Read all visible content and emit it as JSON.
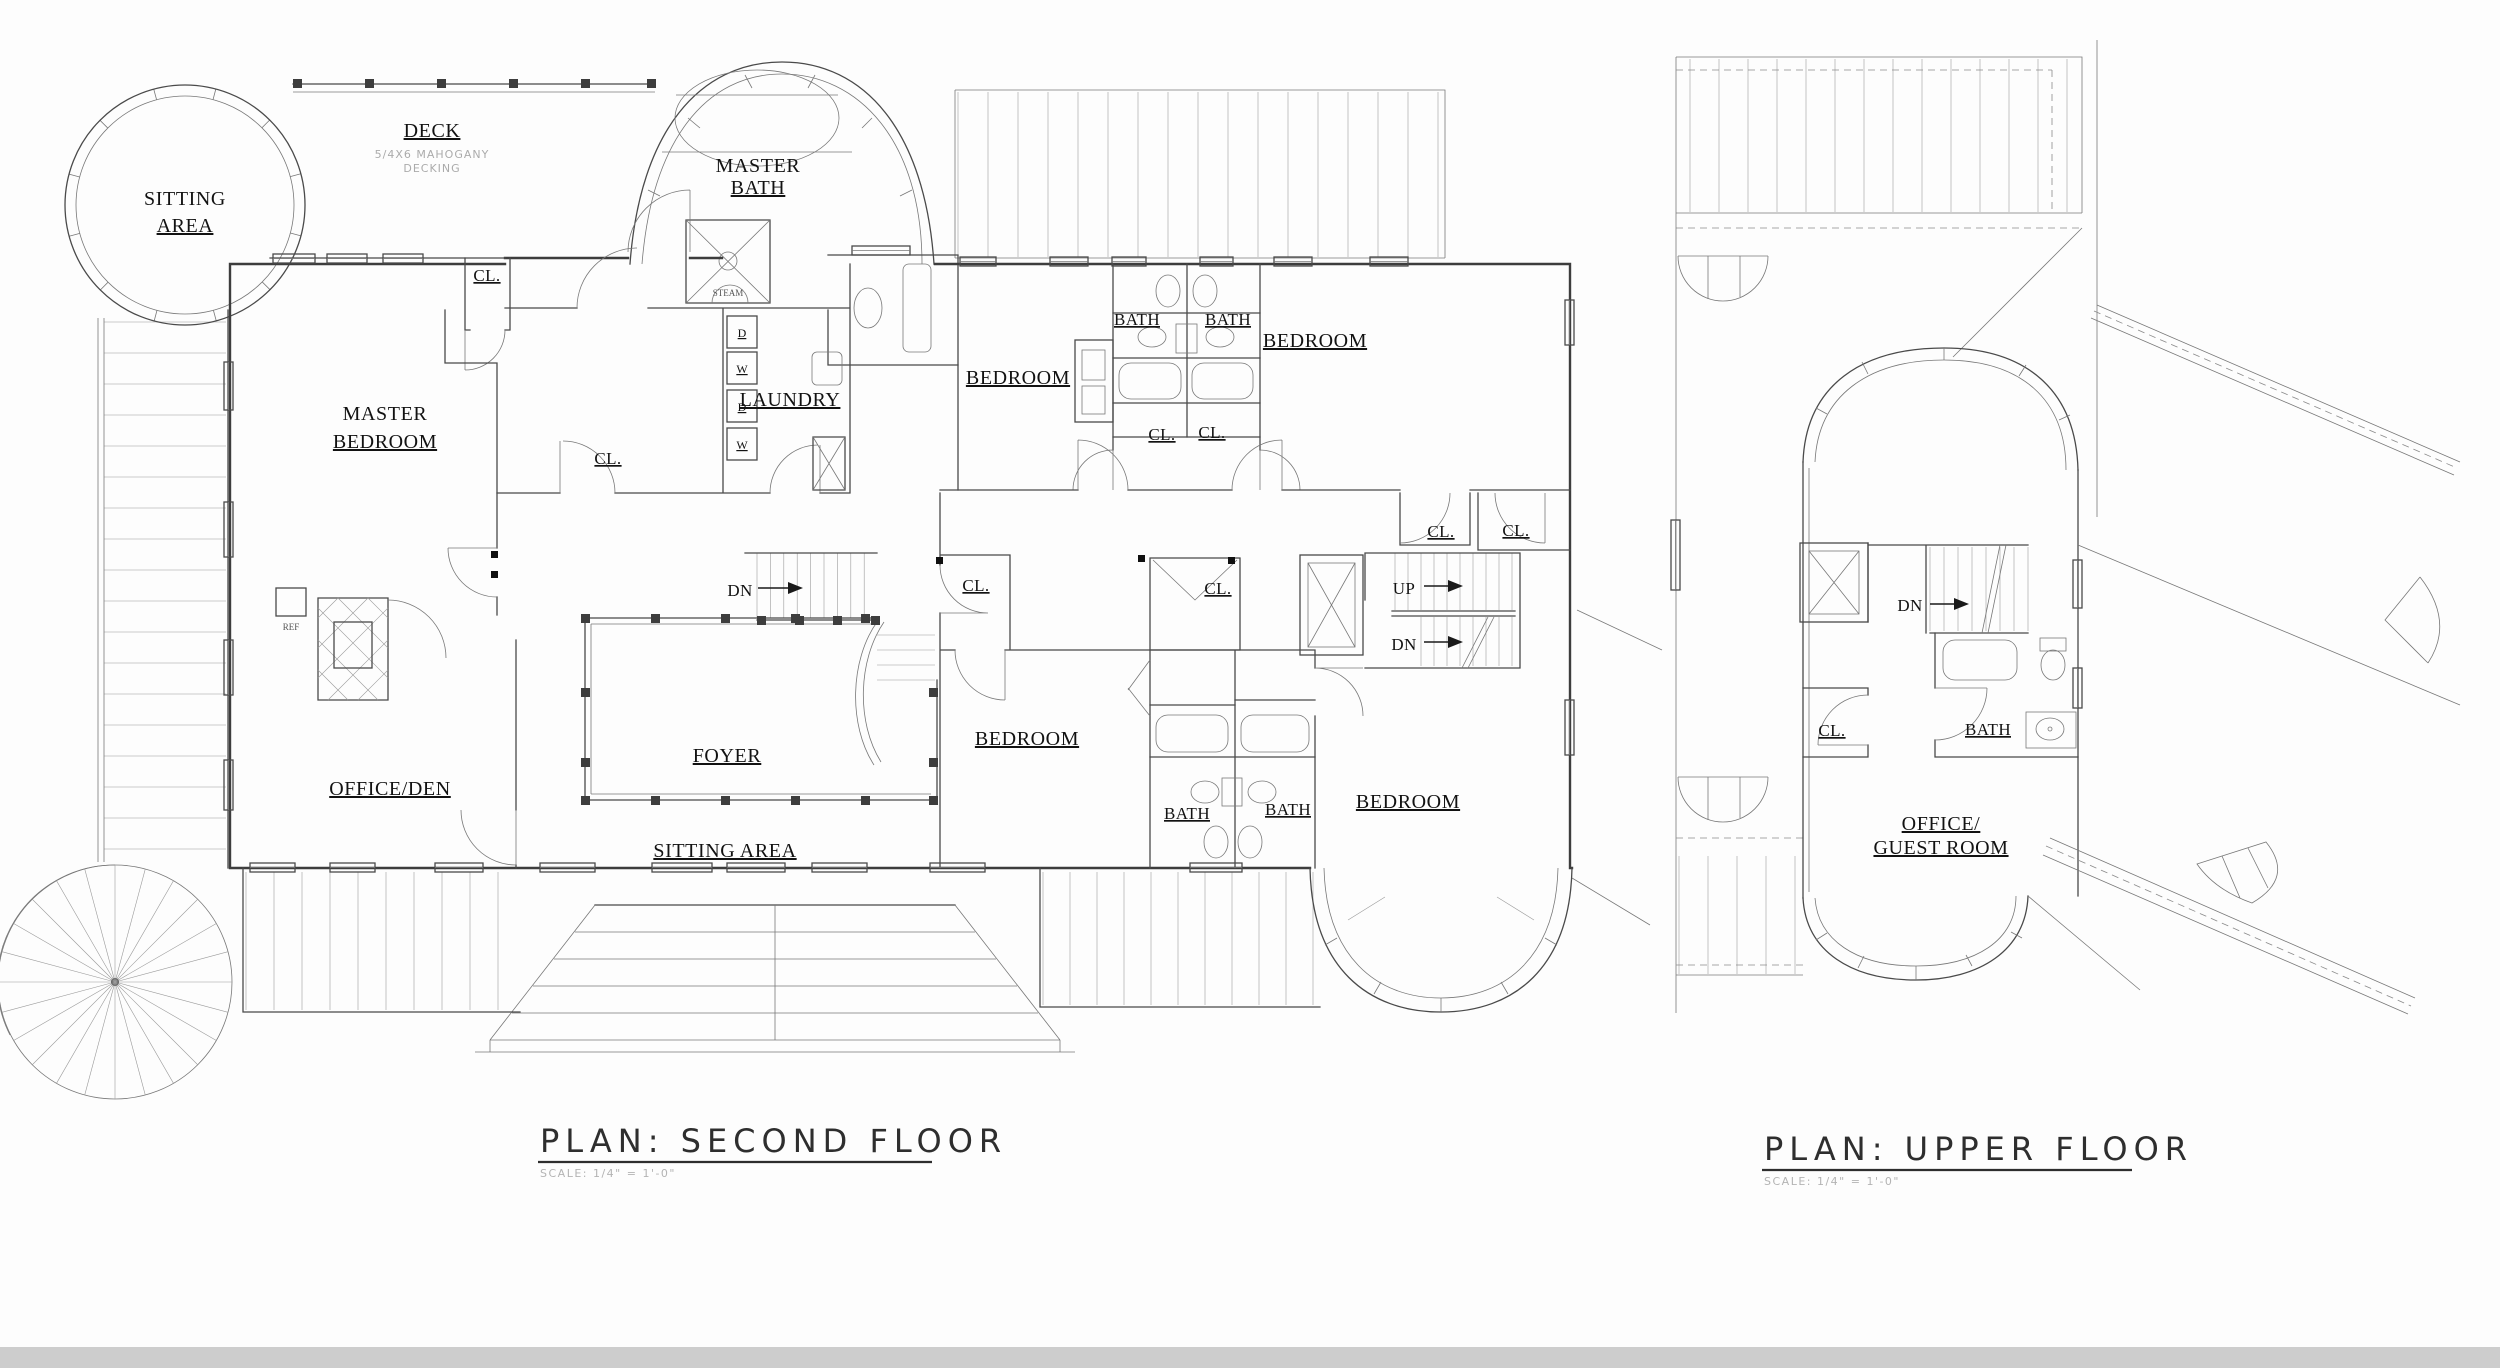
{
  "second_floor": {
    "title": "PLAN: SECOND FLOOR",
    "scale_note": "SCALE: 1/4\" = 1'-0\"",
    "labels": {
      "sitting_turret_1": "SITTING",
      "sitting_turret_2": "AREA",
      "deck": "DECK",
      "deck_note_1": "5/4X6 MAHOGANY",
      "deck_note_2": "DECKING",
      "master_bath_1": "MASTER",
      "master_bath_2": "BATH",
      "steam": "STEAM",
      "closet": "CL.",
      "master_bedroom_1": "MASTER",
      "master_bedroom_2": "BEDROOM",
      "laundry": "LAUNDRY",
      "washer": "W",
      "dryer": "D",
      "ref": "REF",
      "bedroom": "BEDROOM",
      "bath": "BATH",
      "down": "DN",
      "up": "UP",
      "foyer": "FOYER",
      "sitting_area": "SITTING AREA",
      "office_den": "OFFICE/DEN"
    }
  },
  "upper_floor": {
    "title": "PLAN: UPPER FLOOR",
    "scale_note": "SCALE: 1/4\" = 1'-0\"",
    "labels": {
      "down": "DN",
      "closet": "CL.",
      "bath": "BATH",
      "office_guest_1": "OFFICE/",
      "office_guest_2": "GUEST ROOM"
    }
  }
}
